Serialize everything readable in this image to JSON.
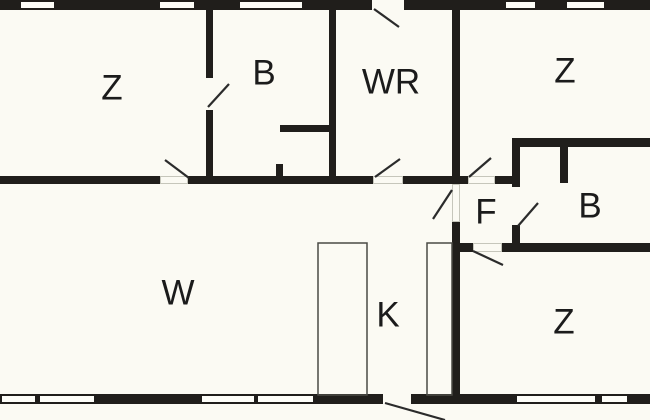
{
  "canvas": {
    "width": 650,
    "height": 420
  },
  "colors": {
    "background": "#fbfaf3",
    "wall": "#201e1b",
    "window_fill": "#fdfdf8",
    "door_line": "#2b2b2b",
    "threshold_line": "#c6c6bb",
    "furniture_line": "#4a4a45",
    "label": "#1b1b1b"
  },
  "label_font_size": 35,
  "rooms": [
    {
      "name": "bedroom-top-left",
      "label": "Z",
      "cx": 112,
      "cy": 88
    },
    {
      "name": "bathroom-top",
      "label": "B",
      "cx": 264,
      "cy": 73
    },
    {
      "name": "utility-room",
      "label": "WR",
      "cx": 391,
      "cy": 82
    },
    {
      "name": "bedroom-top-right",
      "label": "Z",
      "cx": 565,
      "cy": 71
    },
    {
      "name": "hallway",
      "label": "F",
      "cx": 486,
      "cy": 212
    },
    {
      "name": "bathroom-right",
      "label": "B",
      "cx": 590,
      "cy": 206
    },
    {
      "name": "living-room",
      "label": "W",
      "cx": 178,
      "cy": 293
    },
    {
      "name": "kitchen",
      "label": "K",
      "cx": 388,
      "cy": 315
    },
    {
      "name": "bedroom-bottom-right",
      "label": "Z",
      "cx": 564,
      "cy": 322
    }
  ],
  "walls": [
    {
      "x": 0,
      "y": 0,
      "w": 650,
      "h": 10
    },
    {
      "x": 0,
      "y": 394,
      "w": 650,
      "h": 10
    },
    {
      "x": 206,
      "y": 10,
      "w": 7,
      "h": 68
    },
    {
      "x": 206,
      "y": 110,
      "w": 7,
      "h": 66
    },
    {
      "x": 329,
      "y": 10,
      "w": 7,
      "h": 174
    },
    {
      "x": 452,
      "y": 10,
      "w": 8,
      "h": 174
    },
    {
      "x": 452,
      "y": 222,
      "w": 8,
      "h": 172
    },
    {
      "x": 0,
      "y": 176,
      "w": 160,
      "h": 8
    },
    {
      "x": 188,
      "y": 176,
      "w": 185,
      "h": 8
    },
    {
      "x": 403,
      "y": 176,
      "w": 65,
      "h": 8
    },
    {
      "x": 495,
      "y": 176,
      "w": 17,
      "h": 8
    },
    {
      "x": 280,
      "y": 125,
      "w": 56,
      "h": 7
    },
    {
      "x": 276,
      "y": 164,
      "w": 7,
      "h": 12
    },
    {
      "x": 512,
      "y": 138,
      "w": 138,
      "h": 9
    },
    {
      "x": 512,
      "y": 147,
      "w": 8,
      "h": 40
    },
    {
      "x": 512,
      "y": 225,
      "w": 8,
      "h": 18
    },
    {
      "x": 560,
      "y": 147,
      "w": 8,
      "h": 36
    },
    {
      "x": 458,
      "y": 243,
      "w": 15,
      "h": 9
    },
    {
      "x": 502,
      "y": 243,
      "w": 148,
      "h": 9
    }
  ],
  "windows": [
    {
      "x": 21,
      "y": 2,
      "w": 33,
      "h": 6
    },
    {
      "x": 160,
      "y": 2,
      "w": 34,
      "h": 6
    },
    {
      "x": 240,
      "y": 2,
      "w": 62,
      "h": 6
    },
    {
      "x": 506,
      "y": 2,
      "w": 29,
      "h": 6
    },
    {
      "x": 567,
      "y": 2,
      "w": 37,
      "h": 6
    },
    {
      "x": 2,
      "y": 396,
      "w": 33,
      "h": 6
    },
    {
      "x": 40,
      "y": 396,
      "w": 54,
      "h": 6
    },
    {
      "x": 202,
      "y": 396,
      "w": 52,
      "h": 6
    },
    {
      "x": 258,
      "y": 396,
      "w": 55,
      "h": 6
    },
    {
      "x": 517,
      "y": 396,
      "w": 78,
      "h": 6
    },
    {
      "x": 602,
      "y": 396,
      "w": 25,
      "h": 6
    }
  ],
  "door_openings": [
    {
      "x": 372,
      "y": 0,
      "w": 32,
      "h": 10
    },
    {
      "x": 383,
      "y": 394,
      "w": 28,
      "h": 10
    }
  ],
  "thresholds": [
    {
      "x": 160,
      "y": 176,
      "w": 28,
      "h": 8
    },
    {
      "x": 373,
      "y": 176,
      "w": 30,
      "h": 8
    },
    {
      "x": 468,
      "y": 176,
      "w": 27,
      "h": 8
    },
    {
      "x": 452,
      "y": 184,
      "w": 8,
      "h": 38
    },
    {
      "x": 473,
      "y": 243,
      "w": 29,
      "h": 9
    }
  ],
  "door_swings": [
    {
      "x1": 374,
      "y1": 9,
      "x2": 399,
      "y2": 27
    },
    {
      "x1": 208,
      "y1": 107,
      "x2": 229,
      "y2": 84
    },
    {
      "x1": 189,
      "y1": 178,
      "x2": 165,
      "y2": 160
    },
    {
      "x1": 375,
      "y1": 177,
      "x2": 400,
      "y2": 159
    },
    {
      "x1": 469,
      "y1": 177,
      "x2": 491,
      "y2": 158
    },
    {
      "x1": 452,
      "y1": 190,
      "x2": 433,
      "y2": 219
    },
    {
      "x1": 518,
      "y1": 226,
      "x2": 538,
      "y2": 203
    },
    {
      "x1": 473,
      "y1": 251,
      "x2": 503,
      "y2": 265
    },
    {
      "x1": 385,
      "y1": 403,
      "x2": 445,
      "y2": 420
    }
  ],
  "furniture": [
    {
      "name": "kitchen-counter-left",
      "x": 318,
      "y": 243,
      "w": 49,
      "h": 152
    },
    {
      "name": "kitchen-counter-right",
      "x": 427,
      "y": 243,
      "w": 25,
      "h": 152
    }
  ]
}
